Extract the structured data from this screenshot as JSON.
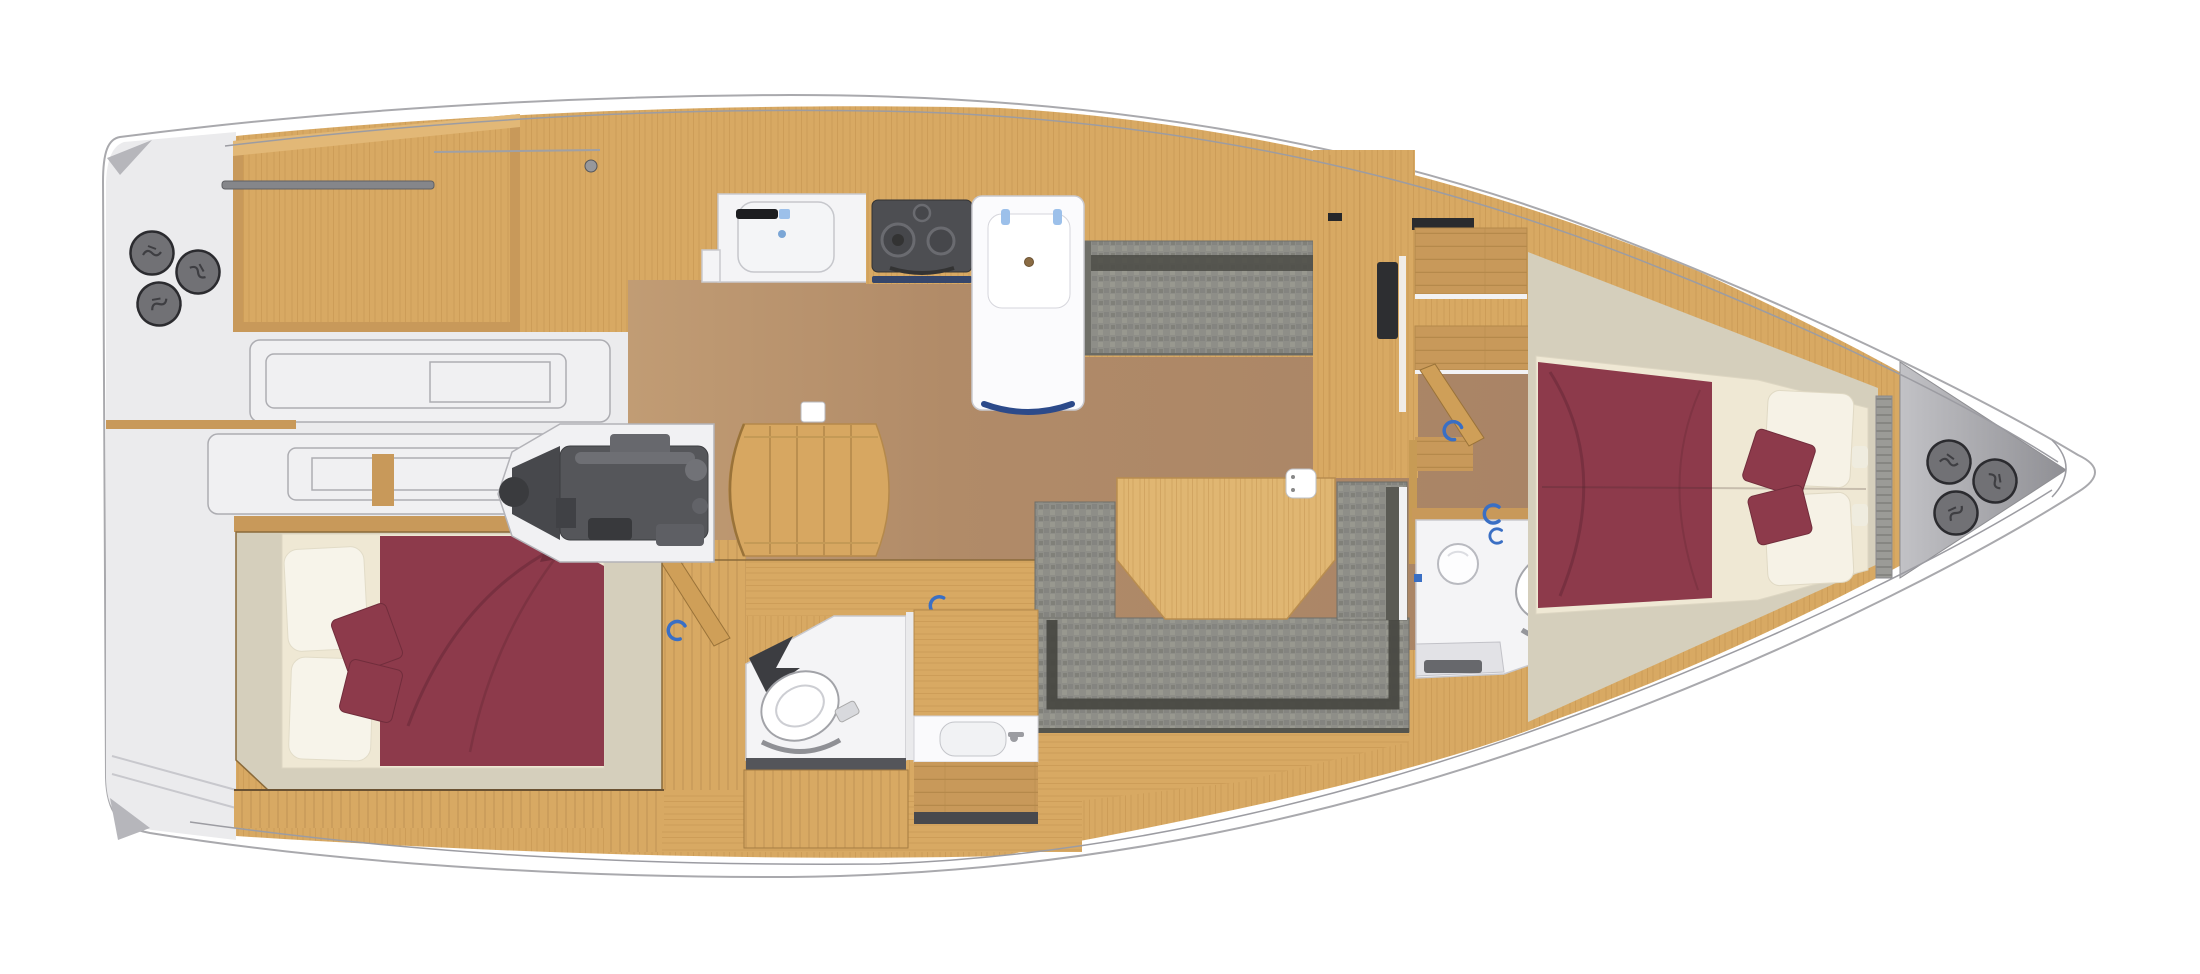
{
  "meta": {
    "title": "Sailing yacht interior deck plan, top view, three-cabin two-head layout"
  },
  "colors": {
    "hull": "#ffffff",
    "hull-line": "#a9a9ad",
    "deck-gray": "#ebebed",
    "deck-shadow": "#b6b6bb",
    "outline-gray": "#adadb2",
    "wood-light": "#d8a963",
    "wood-grain": "#c1914e",
    "wood-frame": "#c8995a",
    "wood-dark": "#9a7339",
    "table-wood": "#e0b672",
    "plank-line": "#b5894b",
    "floor-brown": "#b18b68",
    "floor-brown-light": "#c19c74",
    "greige": "#d5cfbc",
    "cream": "#efe8d4",
    "pillow": "#f7f4ea",
    "maroon": "#8d3a4b",
    "maroon-dark": "#712d3c",
    "fabric": "#8e8e88",
    "fabric-dark": "#4b4b45",
    "fixture": "#f4f4f6",
    "fixture-line": "#c9c9ce",
    "engine": "#55565a",
    "engine-dark": "#3a3b3e",
    "winch": "#717175",
    "winch-ring": "#2b2b2f",
    "handle-blue": "#3a6fc4",
    "hinge-blue": "#9cc0ea",
    "trim-blue": "#35466b",
    "black": "#1c1d20"
  },
  "fixtures": {
    "stern_winches": 3,
    "bow_winches": 3,
    "toilets": 2,
    "galley_sinks": 1,
    "vanity_basins": 2,
    "stove_burners": 3,
    "double_beds": 2,
    "bed_throw_pillows_each": 2,
    "door_handle_color": "blue"
  },
  "regions": [
    {
      "name": "stern-deck",
      "features": [
        "three deck winches",
        "transom steps"
      ]
    },
    {
      "name": "aft-deck-panel",
      "features": [
        "teak panel",
        "traveler track"
      ]
    },
    {
      "name": "side-walkway-steps",
      "features": [
        "molded step outlines"
      ]
    },
    {
      "name": "aft-cabin",
      "features": [
        "double bed",
        "maroon bedspread",
        "two white pillows",
        "two maroon cushions"
      ]
    },
    {
      "name": "engine-room",
      "features": [
        "inboard engine"
      ]
    },
    {
      "name": "companionway-steps",
      "features": [
        "curved wood steps"
      ]
    },
    {
      "name": "galley",
      "features": [
        "sink",
        "faucet",
        "three-burner stove",
        "fridge unit"
      ]
    },
    {
      "name": "salon",
      "features": [
        "brown sole",
        "upper settee"
      ]
    },
    {
      "name": "dinette",
      "features": [
        "U-shaped gray settee",
        "wood table",
        "small white sink box"
      ]
    },
    {
      "name": "aft-head",
      "features": [
        "toilet",
        "vanity with basin"
      ]
    },
    {
      "name": "forward-head",
      "features": [
        "toilet",
        "round basin",
        "shower tray"
      ]
    },
    {
      "name": "wardrobe-bulkhead",
      "features": [
        "TV panel",
        "shelves",
        "sliding door"
      ]
    },
    {
      "name": "forward-cabin",
      "features": [
        "double bed",
        "maroon bedspread",
        "two white pillows",
        "two maroon cushions"
      ]
    },
    {
      "name": "bow-deck",
      "features": [
        "anchor deck",
        "three winches"
      ]
    }
  ]
}
